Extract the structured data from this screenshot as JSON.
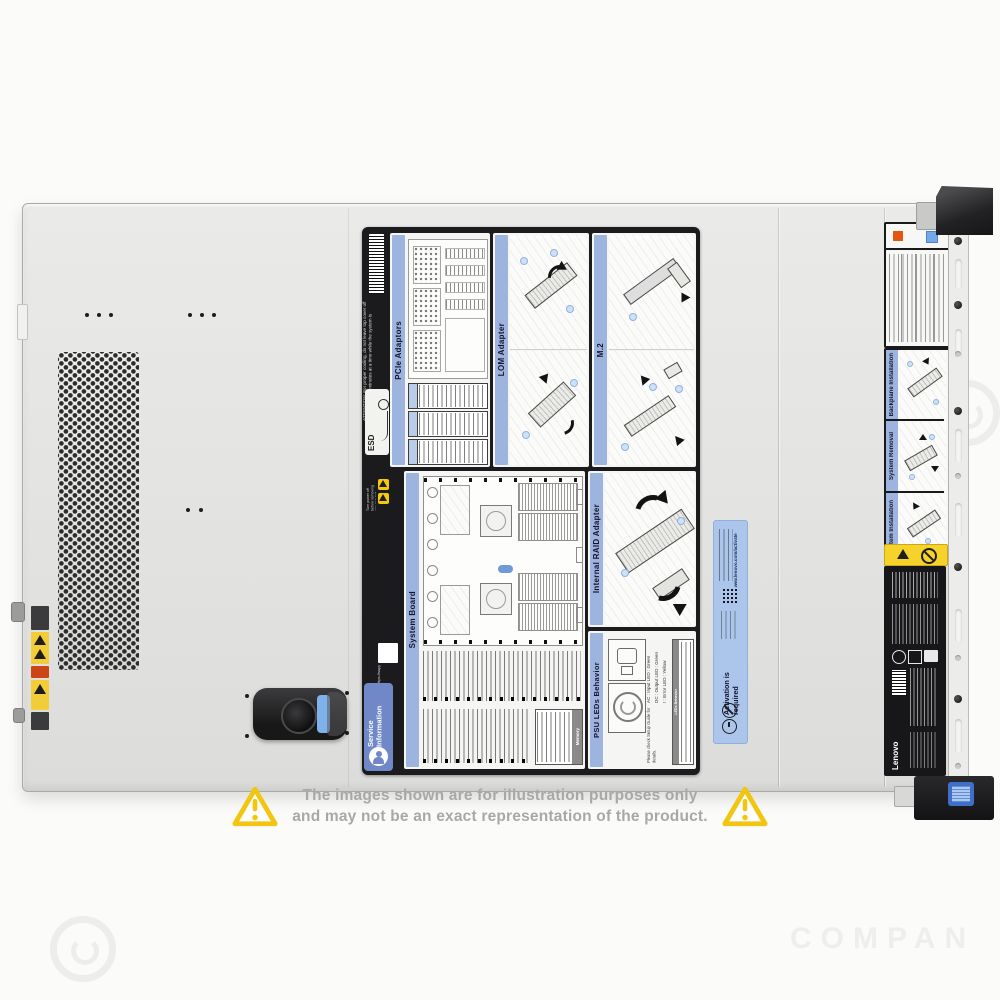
{
  "watermark": {
    "text": "COMPAN"
  },
  "disclaimer": {
    "line1": "The images shown are for illustration purposes only",
    "line2": "and may not be an exact representation of the product."
  },
  "label": {
    "esd": "ESD",
    "attention": "ATTENTION: For proper cooling, do not leave top cover off for more than 2 minutes at a time while the system is running.",
    "warning_small": "Turn power off before removing any non-hot swappable part.",
    "support_url": "https://support.lenovo.com",
    "service": {
      "line1": "Service",
      "line2": "Information"
    },
    "panels": {
      "pcie": {
        "title": "PCIe Adaptors"
      },
      "lom": {
        "title": "LOM Adapter"
      },
      "m2": {
        "title": "M.2"
      },
      "system_board": {
        "title": "System Board",
        "memory": "Memory"
      },
      "raid": {
        "title": "Internal RAID Adapter"
      },
      "psu": {
        "title": "PSU LEDs Behavior",
        "legend": [
          "AC : Input LED : Green",
          "DC : Output LED : Green",
          "! : Error LED : Yellow"
        ],
        "note": "Please check Setup Guide for details.",
        "table_title": "LEDs Behavior"
      }
    }
  },
  "activation": {
    "title": "Activation is required",
    "url": "www.lenovo.com/activate"
  },
  "bezel": {
    "labels": [
      {
        "title": "Backplane Installation"
      },
      {
        "title": "System Removal"
      },
      {
        "title": "System Installation"
      }
    ]
  },
  "regulatory": {
    "brand": "Lenovo"
  }
}
